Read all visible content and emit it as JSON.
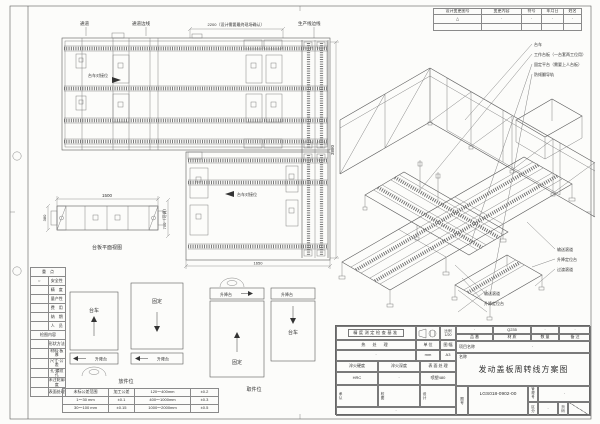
{
  "revision_table": {
    "headers": [
      "设计变更图号",
      "变更内容",
      "符号",
      "年月日",
      "姓名"
    ],
    "row": [
      "△",
      "·",
      "·",
      "·",
      "·"
    ]
  },
  "plan": {
    "corridor": "通道",
    "corridor_edge": "通道边线",
    "production_edge": "生产线边线",
    "dim_2200": "2200（设计需要最终现场确认）",
    "dock_label": "台车对接位",
    "dim_3880": "3880",
    "dim_1650": "1650"
  },
  "side_view": {
    "dim_1500": "1500",
    "dim_380": "380",
    "dim_750": "750（可调）",
    "caption": "台板平面视图"
  },
  "iso": {
    "callout_cart": "台车",
    "callout_worktable": "工作台板（一台套两工位用）",
    "callout_fixed_platform": "固定平台（需要上人台板）",
    "callout_rail": "防倾翻导轨",
    "callout_conveyor_1": "输送滚道",
    "callout_lift_1": "升降定位台",
    "callout_transition": "过渡滚道",
    "callout_conveyor_2": "输送滚道",
    "callout_lift_2": "升降定位台"
  },
  "flow": {
    "cart": "台车",
    "fixed": "固定",
    "lift": "升降台",
    "drop": "放件位",
    "pick": "取件位"
  },
  "checklist": {
    "header1": "重　点",
    "mark": "○",
    "items1": [
      "安全性",
      "精　度",
      "量产性",
      "费　用",
      "纳　期",
      "人　员"
    ],
    "header2": "检图内容",
    "items2": [
      "形状方法",
      "材料·板厚",
      "尺寸·公差",
      "孔·螺纹孔",
      "未注轮廓度",
      "表面处理"
    ]
  },
  "tolerance": {
    "rows": [
      [
        "未标公差范围",
        "加工公差",
        "120～400mm",
        "±0.2"
      ],
      [
        "1～30 mm",
        "±0.1",
        "400～1000mm",
        "±0.3"
      ],
      [
        "30～100 mm",
        "±0.15",
        "1000～2000mm",
        "±0.5"
      ]
    ]
  },
  "title_block": {
    "accuracy": "精度测定检查基准",
    "scale_label": "比例",
    "scale": "1/20",
    "heat_label": "热 处 理",
    "heat": "·",
    "unit_label": "单 位",
    "unit": "mm",
    "size_label": "图 幅",
    "size": "A3",
    "hard_label": "淬火硬度",
    "hard": "HRC",
    "depth_label": "淬火深度",
    "depth": "·",
    "surf_label": "表 面 处 理",
    "surf": "喷塑480",
    "part_label": "品 番",
    "part": "·",
    "mat_label": "材 质",
    "mat": "Q235",
    "qty_label": "数 量",
    "qty": "·",
    "note_label": "备 注",
    "note": "·",
    "proj_label": "项目名称",
    "proj": "·",
    "name_label": "名称",
    "name": "发动盖板周转线方案图",
    "approve": "承认",
    "check": "校图",
    "design": "设计",
    "dwgno_label": "图号",
    "dwgno": "LGS018-0902-00",
    "manage_label": "管理号",
    "manage": "·",
    "div_label": "区分",
    "div": "·",
    "page_label": "页码",
    "bottom_note": "·"
  }
}
